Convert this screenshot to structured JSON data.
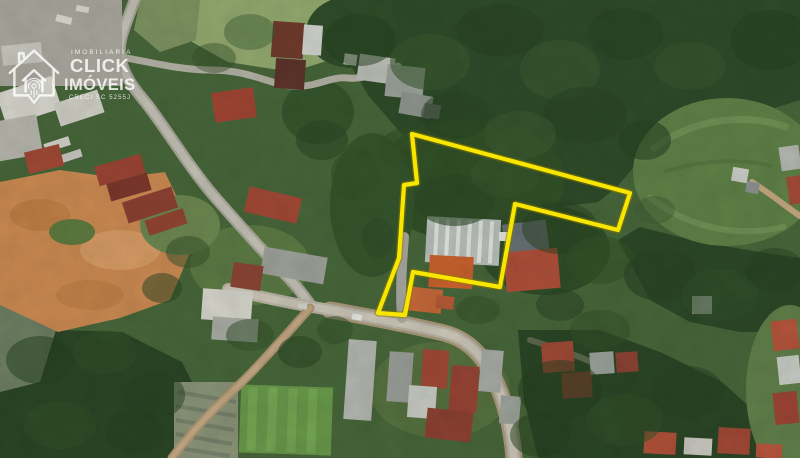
{
  "watermark": {
    "brand_top": "IMOBILIARIA",
    "brand_main": "CLICK",
    "brand_sub": "IMÓVEIS",
    "creci": "CRECI SC 5255J",
    "icon": "house-with-fingerprint-logo"
  },
  "property_outline": {
    "color": "#f8e600",
    "casing_color": "#8a7c00",
    "points": "412,134 417,183 404,185 399,258 378,313 405,315 413,272 500,287 515,204 618,230 630,193"
  },
  "map_palette": {
    "forest_dark": "#2e4b29",
    "vegetation_mid": "#47663a",
    "grass_light": "#93a96f",
    "dirt_field": "#cb8a52",
    "road_gray": "#c3c0b4",
    "dirt_road": "#b09572",
    "roof_red": "#a54a37",
    "roof_orange": "#c8662f",
    "roof_white": "#d6d6cd"
  }
}
